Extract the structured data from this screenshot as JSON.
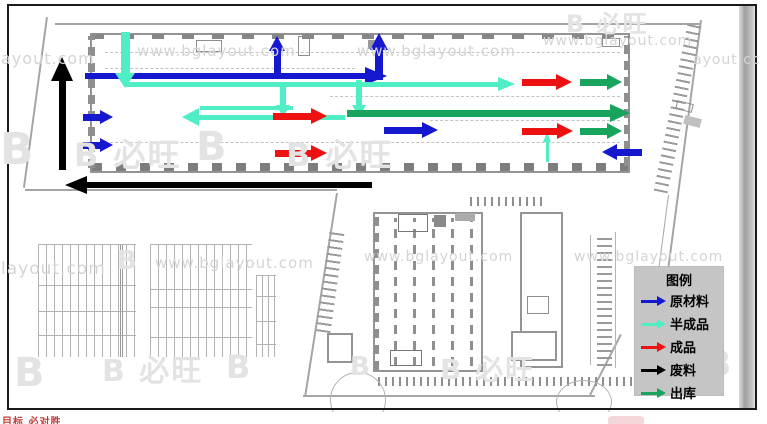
{
  "legend": {
    "title": "图例",
    "items": [
      {
        "key": "raw_material",
        "label": "原材料",
        "color": "#1518cf"
      },
      {
        "key": "semi_finished",
        "label": "半成品",
        "color": "#4feec5"
      },
      {
        "key": "finished",
        "label": "成品",
        "color": "#ee1111"
      },
      {
        "key": "waste",
        "label": "废料",
        "color": "#000000"
      },
      {
        "key": "outbound",
        "label": "出库",
        "color": "#18a45c"
      }
    ]
  },
  "footer": {
    "note": "目标 必对胜"
  },
  "watermark": {
    "url_text": "www.bglayout.com",
    "url_instances": [
      {
        "x": 1,
        "y": 49,
        "s": 16,
        "t": "ayout.com"
      },
      {
        "x": 137,
        "y": 42,
        "s": 15
      },
      {
        "x": 357,
        "y": 42,
        "s": 15
      },
      {
        "x": 543,
        "y": 33,
        "s": 14
      },
      {
        "x": 693,
        "y": 52,
        "s": 14,
        "t": "ayout.cc"
      },
      {
        "x": 1,
        "y": 259,
        "s": 17,
        "t": "layout.com"
      },
      {
        "x": 155,
        "y": 254,
        "s": 15
      },
      {
        "x": 364,
        "y": 249,
        "s": 14
      },
      {
        "x": 574,
        "y": 249,
        "s": 14
      }
    ],
    "logo_instances": [
      {
        "x": 0,
        "y": 124,
        "s": 44,
        "t": "B"
      },
      {
        "x": 74,
        "y": 130,
        "s": 32,
        "t": "B 必旺"
      },
      {
        "x": 196,
        "y": 124,
        "s": 40,
        "t": "B"
      },
      {
        "x": 286,
        "y": 130,
        "s": 32,
        "t": "B 必旺"
      },
      {
        "x": 566,
        "y": 4,
        "s": 24,
        "t": "B 必旺"
      },
      {
        "x": 117,
        "y": 246,
        "s": 26,
        "t": "B"
      },
      {
        "x": 14,
        "y": 350,
        "s": 40,
        "t": "B"
      },
      {
        "x": 102,
        "y": 346,
        "s": 30,
        "t": "B 必旺"
      },
      {
        "x": 226,
        "y": 348,
        "s": 32,
        "t": "B"
      },
      {
        "x": 350,
        "y": 352,
        "s": 26,
        "t": "B"
      },
      {
        "x": 440,
        "y": 348,
        "s": 28,
        "t": "B 必旺"
      },
      {
        "x": 636,
        "y": 334,
        "s": 26,
        "t": "B"
      },
      {
        "x": 704,
        "y": 344,
        "s": 36,
        "t": "B"
      }
    ]
  },
  "flow_arrows": [
    {
      "type": "raw_material",
      "dir": "right",
      "x": 85,
      "y": 76,
      "len": 302,
      "th": 6,
      "hl": 22,
      "hw": 18
    },
    {
      "type": "raw_material",
      "dir": "up",
      "x": 277,
      "y": 77,
      "len": 41,
      "th": 7,
      "hl": 15,
      "hw": 17
    },
    {
      "type": "raw_material",
      "dir": "up",
      "x": 379,
      "y": 80,
      "len": 47,
      "th": 8,
      "hl": 17,
      "hw": 19
    },
    {
      "type": "raw_material",
      "dir": "right",
      "x": 83,
      "y": 117,
      "len": 30,
      "th": 7,
      "hl": 13,
      "hw": 15
    },
    {
      "type": "raw_material",
      "dir": "right",
      "x": 83,
      "y": 145,
      "len": 30,
      "th": 7,
      "hl": 13,
      "hw": 15
    },
    {
      "type": "raw_material",
      "dir": "right",
      "x": 384,
      "y": 130,
      "len": 54,
      "th": 7,
      "hl": 16,
      "hw": 17
    },
    {
      "type": "raw_material",
      "dir": "left",
      "x": 642,
      "y": 152,
      "len": 40,
      "th": 7,
      "hl": 15,
      "hw": 17
    },
    {
      "type": "semi_finished",
      "dir": "down",
      "x": 125,
      "y": 32,
      "len": 56,
      "th": 9,
      "hl": 15,
      "hw": 21
    },
    {
      "type": "semi_finished",
      "dir": "right",
      "x": 125,
      "y": 84,
      "len": 390,
      "th": 5,
      "hl": 17,
      "hw": 15
    },
    {
      "type": "semi_finished",
      "dir": "down",
      "x": 283,
      "y": 86,
      "len": 31,
      "th": 6,
      "hl": 12,
      "hw": 15
    },
    {
      "type": "semi_finished",
      "dir": "down",
      "x": 359,
      "y": 80,
      "len": 37,
      "th": 6,
      "hl": 12,
      "hw": 15
    },
    {
      "type": "semi_finished",
      "dir": "left",
      "x": 345,
      "y": 117,
      "len": 163,
      "th": 5,
      "hl": 17,
      "hw": 19
    },
    {
      "type": "semi_finished",
      "dir": "right",
      "x": 200,
      "y": 108,
      "len": 93,
      "th": 4,
      "hl": 0,
      "hw": 0
    },
    {
      "type": "semi_finished",
      "dir": "up",
      "x": 547,
      "y": 162,
      "len": 29,
      "th": 3,
      "hl": 9,
      "hw": 9
    },
    {
      "type": "finished",
      "dir": "right",
      "x": 273,
      "y": 116,
      "len": 54,
      "th": 7,
      "hl": 16,
      "hw": 17
    },
    {
      "type": "finished",
      "dir": "right",
      "x": 275,
      "y": 153,
      "len": 52,
      "th": 7,
      "hl": 16,
      "hw": 17
    },
    {
      "type": "finished",
      "dir": "right",
      "x": 522,
      "y": 82,
      "len": 50,
      "th": 7,
      "hl": 16,
      "hw": 17
    },
    {
      "type": "finished",
      "dir": "right",
      "x": 522,
      "y": 131,
      "len": 51,
      "th": 7,
      "hl": 16,
      "hw": 17
    },
    {
      "type": "outbound",
      "dir": "right",
      "x": 580,
      "y": 82,
      "len": 42,
      "th": 7,
      "hl": 15,
      "hw": 16
    },
    {
      "type": "outbound",
      "dir": "right",
      "x": 347,
      "y": 113,
      "len": 283,
      "th": 7,
      "hl": 20,
      "hw": 18
    },
    {
      "type": "outbound",
      "dir": "right",
      "x": 580,
      "y": 131,
      "len": 42,
      "th": 7,
      "hl": 15,
      "hw": 16
    },
    {
      "type": "waste",
      "dir": "up",
      "x": 62,
      "y": 170,
      "len": 113,
      "th": 7,
      "hl": 24,
      "hw": 22
    },
    {
      "type": "waste",
      "dir": "left",
      "x": 372,
      "y": 185,
      "len": 307,
      "th": 6,
      "hl": 22,
      "hw": 19
    }
  ]
}
